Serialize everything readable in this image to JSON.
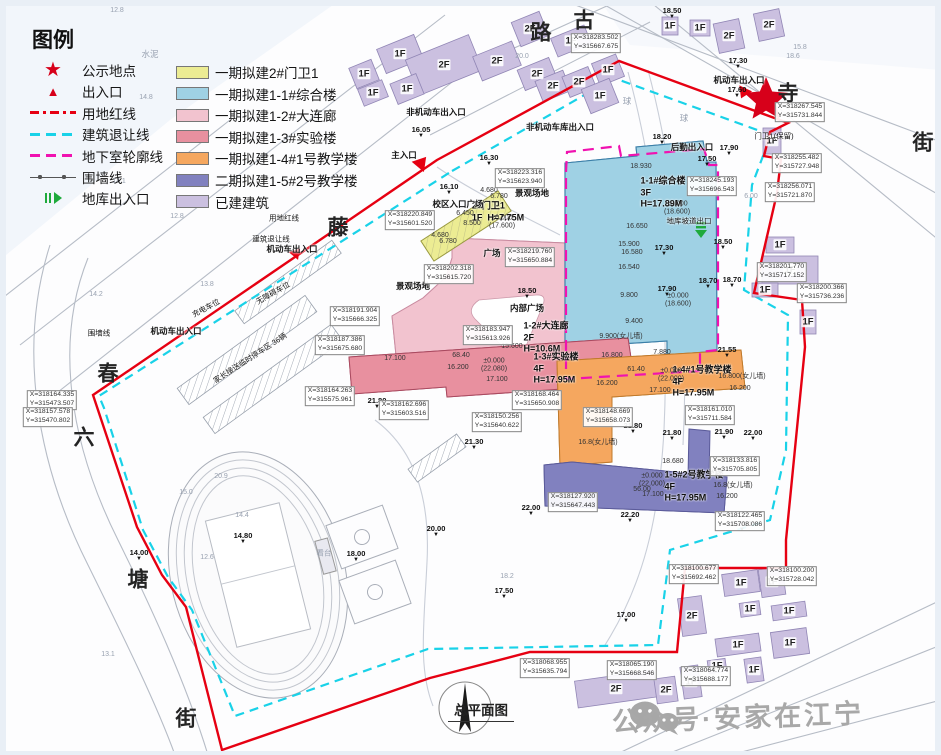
{
  "title": "总平面图",
  "watermark": {
    "text": "公众号·安家在江宁"
  },
  "legend": {
    "title": "图例",
    "symbols": [
      {
        "label": "公示地点",
        "icon": "star"
      },
      {
        "label": "出入口",
        "icon": "triangle"
      },
      {
        "label": "用地红线",
        "icon": "redline"
      },
      {
        "label": "建筑退让线",
        "icon": "cyanline"
      },
      {
        "label": "地下室轮廓线",
        "icon": "magline"
      },
      {
        "label": "围墙线",
        "icon": "wallline"
      },
      {
        "label": "地库出入口",
        "icon": "garage"
      }
    ],
    "colors": [
      {
        "label": "一期拟建2#门卫1",
        "color": "#ecec93"
      },
      {
        "label": "一期拟建1-1#综合楼",
        "color": "#9fd1e4"
      },
      {
        "label": "一期拟建1-2#大连廊",
        "color": "#f2c3cf"
      },
      {
        "label": "一期拟建1-3#实验楼",
        "color": "#e8909f"
      },
      {
        "label": "一期拟建1-4#1号教学楼",
        "color": "#f5a75f"
      },
      {
        "label": "二期拟建1-5#2号教学楼",
        "color": "#8181bf"
      },
      {
        "label": "已建建筑",
        "color": "#cbc0e0"
      }
    ]
  },
  "map": {
    "boundary_colors": {
      "red_line": "#e60012",
      "setback_line": "#19d2e8",
      "basement_line": "#f012b0",
      "garage_green": "#1faa3c"
    },
    "streets": [
      {
        "t": "古",
        "x": 584,
        "y": 21
      },
      {
        "t": "路",
        "x": 541,
        "y": 33
      },
      {
        "t": "寺",
        "x": 788,
        "y": 94
      },
      {
        "t": "街",
        "x": 923,
        "y": 143
      },
      {
        "t": "藤",
        "x": 338,
        "y": 228
      },
      {
        "t": "春",
        "x": 108,
        "y": 374
      },
      {
        "t": "六",
        "x": 84,
        "y": 438
      },
      {
        "t": "塘",
        "x": 138,
        "y": 580
      },
      {
        "t": "街",
        "x": 186,
        "y": 719
      }
    ],
    "building_names": [
      {
        "t": "1-1#综合楼\n3F\nH=17.89M",
        "x": 663,
        "y": 193
      },
      {
        "t": "1-2#大连廊\n2F\nH=10.6M",
        "x": 546,
        "y": 338
      },
      {
        "t": "1-3#实验楼\n4F\nH=17.95M",
        "x": 556,
        "y": 369
      },
      {
        "t": "1-4#1号教学楼\n4F\nH=17.95M",
        "x": 702,
        "y": 382
      },
      {
        "t": "1-5#2号教学楼\n4F\nH=17.95M",
        "x": 694,
        "y": 487
      },
      {
        "t": "2#门卫1\n1F  H=7.75M",
        "x": 498,
        "y": 212
      }
    ],
    "annotations": [
      {
        "t": "主入口",
        "x": 404,
        "y": 155
      },
      {
        "t": "机动车出入口",
        "x": 739,
        "y": 80
      },
      {
        "t": "机动车出入口",
        "x": 292,
        "y": 249
      },
      {
        "t": "机动车出入口",
        "x": 176,
        "y": 331
      },
      {
        "t": "非机动车出入口",
        "x": 436,
        "y": 112
      },
      {
        "t": "非机动车库出入口",
        "x": 560,
        "y": 127
      },
      {
        "t": "后勤出入口",
        "x": 692,
        "y": 147
      },
      {
        "t": "校区入口广场",
        "x": 458,
        "y": 204
      },
      {
        "t": "景观场地",
        "x": 532,
        "y": 193
      },
      {
        "t": "景观场地",
        "x": 413,
        "y": 286
      },
      {
        "t": "广场",
        "x": 492,
        "y": 253
      },
      {
        "t": "内部广场",
        "x": 527,
        "y": 308
      },
      {
        "t": "地库坡道出口",
        "x": 689,
        "y": 221,
        "small": 1
      },
      {
        "t": "家长接送临时停车区 36辆",
        "x": 250,
        "y": 358,
        "r": -33,
        "small": 1
      },
      {
        "t": "无障碍车位",
        "x": 273,
        "y": 293,
        "r": -30,
        "small": 1
      },
      {
        "t": "充电车位",
        "x": 206,
        "y": 308,
        "r": -28,
        "small": 1
      },
      {
        "t": "围墙线",
        "x": 99,
        "y": 333,
        "small": 1
      },
      {
        "t": "用地红线",
        "x": 284,
        "y": 218,
        "small": 1
      },
      {
        "t": "建筑退让线",
        "x": 271,
        "y": 239,
        "small": 1
      },
      {
        "t": "门卫1(保留)",
        "x": 774,
        "y": 136,
        "small": 1
      },
      {
        "t": "看台",
        "x": 324,
        "y": 553,
        "small": 1,
        "faint": 1
      },
      {
        "t": "水泥",
        "x": 150,
        "y": 54,
        "faint": 1
      },
      {
        "t": "球",
        "x": 627,
        "y": 101,
        "faint": 1
      },
      {
        "t": "球",
        "x": 684,
        "y": 118,
        "faint": 1
      }
    ],
    "elevations": [
      {
        "t": "18.50",
        "x": 672,
        "y": 13
      },
      {
        "t": "17.30",
        "x": 738,
        "y": 63
      },
      {
        "t": "17.60",
        "x": 737,
        "y": 92
      },
      {
        "t": "18.20",
        "x": 662,
        "y": 139
      },
      {
        "t": "17.90",
        "x": 729,
        "y": 150
      },
      {
        "t": "17.50",
        "x": 707,
        "y": 161
      },
      {
        "t": "18.50",
        "x": 723,
        "y": 244
      },
      {
        "t": "18.70",
        "x": 708,
        "y": 283
      },
      {
        "t": "18.70",
        "x": 732,
        "y": 282
      },
      {
        "t": "21.55",
        "x": 727,
        "y": 352
      },
      {
        "t": "17.30",
        "x": 664,
        "y": 250
      },
      {
        "t": "17.90",
        "x": 667,
        "y": 291
      },
      {
        "t": "18.50",
        "x": 527,
        "y": 293
      },
      {
        "t": "16.05",
        "x": 421,
        "y": 132
      },
      {
        "t": "16.10",
        "x": 449,
        "y": 189
      },
      {
        "t": "16.30",
        "x": 489,
        "y": 160
      },
      {
        "t": "21.80",
        "x": 377,
        "y": 403
      },
      {
        "t": "21.30",
        "x": 474,
        "y": 444
      },
      {
        "t": "20.00",
        "x": 436,
        "y": 531
      },
      {
        "t": "18.00",
        "x": 356,
        "y": 556
      },
      {
        "t": "17.50",
        "x": 504,
        "y": 593
      },
      {
        "t": "22.00",
        "x": 531,
        "y": 510
      },
      {
        "t": "21.80",
        "x": 633,
        "y": 428
      },
      {
        "t": "21.80",
        "x": 672,
        "y": 435
      },
      {
        "t": "21.90",
        "x": 724,
        "y": 434
      },
      {
        "t": "22.00",
        "x": 753,
        "y": 435
      },
      {
        "t": "22.20",
        "x": 630,
        "y": 517
      },
      {
        "t": "21.50",
        "x": 742,
        "y": 526
      },
      {
        "t": "14.80",
        "x": 243,
        "y": 538
      },
      {
        "t": "14.00",
        "x": 139,
        "y": 555
      },
      {
        "t": "17.00",
        "x": 626,
        "y": 617
      }
    ],
    "dims": [
      {
        "t": "18.930",
        "x": 641,
        "y": 167
      },
      {
        "t": "16.650",
        "x": 637,
        "y": 227
      },
      {
        "t": "15.900",
        "x": 629,
        "y": 245
      },
      {
        "t": "16.580",
        "x": 632,
        "y": 253
      },
      {
        "t": "16.540",
        "x": 629,
        "y": 268
      },
      {
        "t": "9.800",
        "x": 629,
        "y": 296
      },
      {
        "t": "±0.000\n(18.600)",
        "x": 677,
        "y": 209
      },
      {
        "t": "±0.000\n(18.600)",
        "x": 678,
        "y": 301
      },
      {
        "t": "9.400",
        "x": 634,
        "y": 322
      },
      {
        "t": "9.900(女儿墙)",
        "x": 621,
        "y": 337
      },
      {
        "t": "16.800",
        "x": 612,
        "y": 356
      },
      {
        "t": "7.880",
        "x": 662,
        "y": 353
      },
      {
        "t": "15.600",
        "x": 512,
        "y": 347
      },
      {
        "t": "±0.000\n(22.080)",
        "x": 494,
        "y": 366
      },
      {
        "t": "17.100",
        "x": 497,
        "y": 380
      },
      {
        "t": "16.200",
        "x": 458,
        "y": 368
      },
      {
        "t": "17.100",
        "x": 395,
        "y": 359
      },
      {
        "t": "68.40",
        "x": 461,
        "y": 356
      },
      {
        "t": "±0.000\n(22.000)",
        "x": 671,
        "y": 376
      },
      {
        "t": "16.200",
        "x": 607,
        "y": 384
      },
      {
        "t": "17.100",
        "x": 660,
        "y": 391
      },
      {
        "t": "61.40",
        "x": 636,
        "y": 370
      },
      {
        "t": "16.800(女儿墙)",
        "x": 742,
        "y": 377
      },
      {
        "t": "16.200",
        "x": 740,
        "y": 389
      },
      {
        "t": "±0.000\n(22.000)",
        "x": 652,
        "y": 481
      },
      {
        "t": "17.100",
        "x": 653,
        "y": 495
      },
      {
        "t": "56.00",
        "x": 642,
        "y": 490
      },
      {
        "t": "16.200",
        "x": 727,
        "y": 497
      },
      {
        "t": "16.8(女儿墙)",
        "x": 733,
        "y": 486
      },
      {
        "t": "16.8(女儿墙)",
        "x": 598,
        "y": 443
      },
      {
        "t": "18.680",
        "x": 673,
        "y": 462
      },
      {
        "t": "6.450",
        "x": 465,
        "y": 214
      },
      {
        "t": "8.500",
        "x": 472,
        "y": 224
      },
      {
        "t": "±0.000\n(17.600)",
        "x": 502,
        "y": 223
      },
      {
        "t": "4.680",
        "x": 489,
        "y": 191
      },
      {
        "t": "6.780",
        "x": 499,
        "y": 197
      },
      {
        "t": "4.680",
        "x": 440,
        "y": 236
      },
      {
        "t": "6.780",
        "x": 448,
        "y": 242
      },
      {
        "t": "20.9",
        "x": 221,
        "y": 477,
        "faint": 1
      },
      {
        "t": "15.0",
        "x": 186,
        "y": 493,
        "faint": 1
      },
      {
        "t": "14.4",
        "x": 242,
        "y": 516,
        "faint": 1
      },
      {
        "t": "12.6",
        "x": 207,
        "y": 558,
        "faint": 1
      },
      {
        "t": "12.8",
        "x": 117,
        "y": 11,
        "faint": 1
      },
      {
        "t": "14.8",
        "x": 146,
        "y": 98,
        "faint": 1
      },
      {
        "t": "14.1",
        "x": 119,
        "y": 182,
        "faint": 1
      },
      {
        "t": "12.8",
        "x": 177,
        "y": 217,
        "faint": 1
      },
      {
        "t": "14.2",
        "x": 96,
        "y": 295,
        "faint": 1
      },
      {
        "t": "13.8",
        "x": 207,
        "y": 285,
        "faint": 1
      },
      {
        "t": "18.2",
        "x": 507,
        "y": 577,
        "faint": 1
      },
      {
        "t": "13.1",
        "x": 108,
        "y": 655,
        "faint": 1
      },
      {
        "t": "20.0",
        "x": 522,
        "y": 57,
        "faint": 1
      },
      {
        "t": "18.6",
        "x": 793,
        "y": 57,
        "faint": 1
      },
      {
        "t": "15.8",
        "x": 800,
        "y": 48,
        "faint": 1
      },
      {
        "t": "6.00",
        "x": 751,
        "y": 197,
        "faint": 1
      }
    ],
    "coords": [
      {
        "t": "X=318267.545\nY=315731.844",
        "x": 800,
        "y": 112
      },
      {
        "t": "X=318255.482\nY=315727.948",
        "x": 797,
        "y": 163
      },
      {
        "t": "X=318256.071\nY=315721.870",
        "x": 790,
        "y": 192
      },
      {
        "t": "X=318245.193\nY=315696.543",
        "x": 712,
        "y": 186
      },
      {
        "t": "X=318283.502\nY=315667.675",
        "x": 596,
        "y": 43
      },
      {
        "t": "X=318201.770\nY=315717.152",
        "x": 782,
        "y": 272
      },
      {
        "t": "X=318200.366\nY=315736.236",
        "x": 822,
        "y": 293
      },
      {
        "t": "X=318220.849\nY=315601.520",
        "x": 410,
        "y": 220
      },
      {
        "t": "X=318223.316\nY=315623.940",
        "x": 520,
        "y": 178
      },
      {
        "t": "X=318219.760\nY=315650.884",
        "x": 530,
        "y": 257
      },
      {
        "t": "X=318202.318\nY=315615.720",
        "x": 449,
        "y": 274
      },
      {
        "t": "X=318183.947\nY=315613.926",
        "x": 488,
        "y": 335
      },
      {
        "t": "X=318187.386\nY=315675.680",
        "x": 340,
        "y": 345
      },
      {
        "t": "X=318191.904\nY=315666.325",
        "x": 355,
        "y": 316
      },
      {
        "t": "X=318164.263\nY=315575.961",
        "x": 330,
        "y": 396
      },
      {
        "t": "X=318162.696\nY=315603.516",
        "x": 404,
        "y": 410
      },
      {
        "t": "X=318150.256\nY=315640.622",
        "x": 497,
        "y": 422
      },
      {
        "t": "X=318168.464\nY=315650.908",
        "x": 537,
        "y": 400
      },
      {
        "t": "X=318148.669\nY=315658.073",
        "x": 608,
        "y": 417
      },
      {
        "t": "X=318161.010\nY=315711.584",
        "x": 710,
        "y": 415
      },
      {
        "t": "X=318127.920\nY=315647.443",
        "x": 573,
        "y": 502
      },
      {
        "t": "X=318133.816\nY=315705.805",
        "x": 735,
        "y": 466
      },
      {
        "t": "X=318122.465\nY=315708.086",
        "x": 740,
        "y": 521
      },
      {
        "t": "X=318164.335\nY=315473.507",
        "x": 52,
        "y": 400
      },
      {
        "t": "X=318157.578\nY=315470.802",
        "x": 48,
        "y": 417
      },
      {
        "t": "X=318068.955\nY=315635.794",
        "x": 545,
        "y": 668
      },
      {
        "t": "X=318065.190\nY=315668.546",
        "x": 632,
        "y": 670
      },
      {
        "t": "X=318100.677\nY=315692.462",
        "x": 694,
        "y": 574
      },
      {
        "t": "X=318100.200\nY=315728.042",
        "x": 792,
        "y": 576
      },
      {
        "t": "X=318064.774\nY=315688.177",
        "x": 706,
        "y": 676
      }
    ],
    "existing_buildings": [
      {
        "x": 364,
        "y": 74,
        "w": 24,
        "h": 22,
        "r": -22,
        "f": "1F"
      },
      {
        "x": 400,
        "y": 54,
        "w": 40,
        "h": 26,
        "r": -22,
        "f": "1F"
      },
      {
        "x": 444,
        "y": 65,
        "w": 68,
        "h": 38,
        "r": -22,
        "f": "2F"
      },
      {
        "x": 373,
        "y": 93,
        "w": 26,
        "h": 18,
        "r": -22,
        "f": "1F"
      },
      {
        "x": 407,
        "y": 89,
        "w": 28,
        "h": 22,
        "r": -22,
        "f": "1F"
      },
      {
        "x": 497,
        "y": 61,
        "w": 42,
        "h": 26,
        "r": -22,
        "f": "2F"
      },
      {
        "x": 530,
        "y": 29,
        "w": 30,
        "h": 26,
        "r": -22,
        "f": "2F"
      },
      {
        "x": 537,
        "y": 74,
        "w": 34,
        "h": 22,
        "r": -22,
        "f": "2F"
      },
      {
        "x": 571,
        "y": 41,
        "w": 36,
        "h": 20,
        "r": -22,
        "f": "1F"
      },
      {
        "x": 553,
        "y": 86,
        "w": 30,
        "h": 22,
        "r": -22,
        "f": "2F"
      },
      {
        "x": 579,
        "y": 82,
        "w": 28,
        "h": 22,
        "r": -22,
        "f": "2F"
      },
      {
        "x": 608,
        "y": 70,
        "w": 26,
        "h": 24,
        "r": -22,
        "f": "1F"
      },
      {
        "x": 600,
        "y": 96,
        "w": 30,
        "h": 26,
        "r": -22,
        "f": "1F"
      },
      {
        "x": 670,
        "y": 26,
        "w": 16,
        "h": 18,
        "r": 0,
        "f": "1F"
      },
      {
        "x": 700,
        "y": 28,
        "w": 20,
        "h": 16,
        "r": 0,
        "f": "1F"
      },
      {
        "x": 729,
        "y": 36,
        "w": 26,
        "h": 30,
        "r": -12,
        "f": "2F"
      },
      {
        "x": 769,
        "y": 25,
        "w": 26,
        "h": 28,
        "r": -12,
        "f": "2F"
      },
      {
        "x": 772,
        "y": 141,
        "w": 18,
        "h": 26,
        "r": 0,
        "f": "1F"
      },
      {
        "x": 780,
        "y": 245,
        "w": 28,
        "h": 16,
        "r": 0,
        "f": "1F"
      },
      {
        "x": 790,
        "y": 270,
        "w": 56,
        "h": 28,
        "r": 0,
        "f": "1F"
      },
      {
        "x": 765,
        "y": 290,
        "w": 26,
        "h": 14,
        "r": 0,
        "f": "1F"
      },
      {
        "x": 808,
        "y": 322,
        "w": 16,
        "h": 24,
        "r": 0,
        "f": "1F"
      },
      {
        "x": 741,
        "y": 583,
        "w": 36,
        "h": 22,
        "r": -8,
        "f": "1F"
      },
      {
        "x": 772,
        "y": 582,
        "w": 24,
        "h": 28,
        "r": -8,
        "f": "1F"
      },
      {
        "x": 692,
        "y": 616,
        "w": 24,
        "h": 38,
        "r": -8,
        "f": "2F"
      },
      {
        "x": 750,
        "y": 609,
        "w": 20,
        "h": 14,
        "r": -8,
        "f": "1F"
      },
      {
        "x": 789,
        "y": 611,
        "w": 34,
        "h": 15,
        "r": -8,
        "f": "1F"
      },
      {
        "x": 738,
        "y": 645,
        "w": 44,
        "h": 18,
        "r": -8,
        "f": "1F"
      },
      {
        "x": 790,
        "y": 643,
        "w": 36,
        "h": 26,
        "r": -8,
        "f": "1F"
      },
      {
        "x": 717,
        "y": 666,
        "w": 18,
        "h": 13,
        "r": -8,
        "f": "1F"
      },
      {
        "x": 754,
        "y": 670,
        "w": 17,
        "h": 24,
        "r": -8,
        "f": "1F"
      },
      {
        "x": 691,
        "y": 682,
        "w": 18,
        "h": 32,
        "r": -8,
        "f": "1F"
      },
      {
        "x": 616,
        "y": 689,
        "w": 80,
        "h": 27,
        "r": -8,
        "f": "2F"
      },
      {
        "x": 666,
        "y": 690,
        "w": 21,
        "h": 25,
        "r": -8,
        "f": "2F"
      }
    ]
  }
}
